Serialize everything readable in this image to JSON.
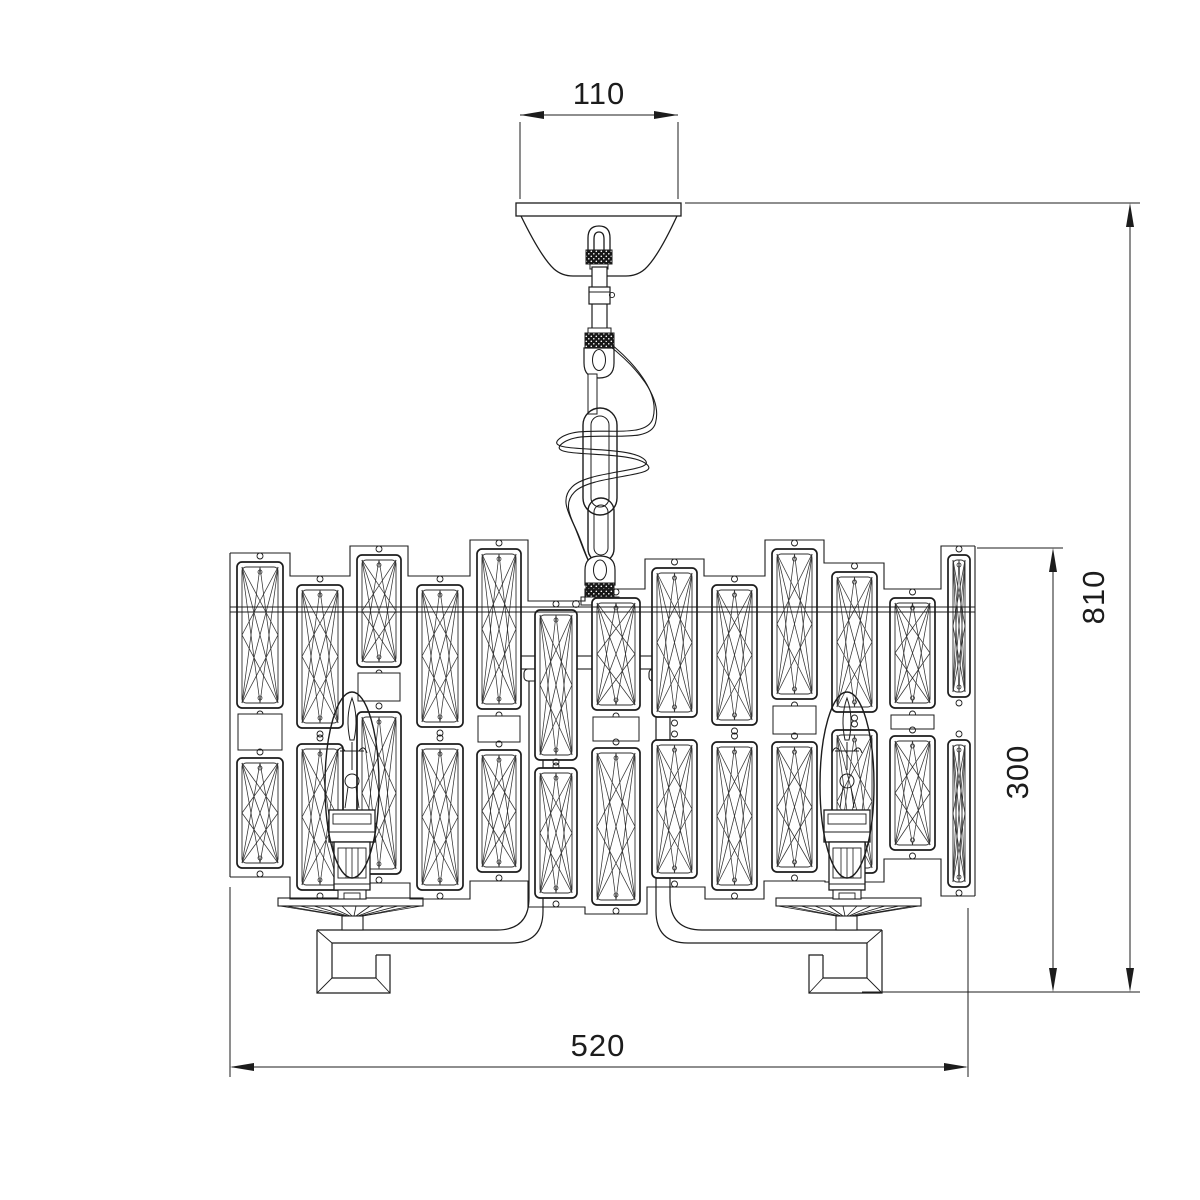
{
  "drawing": {
    "dimensions": {
      "canopy_width": "110",
      "overall_height": "810",
      "body_height": "300",
      "body_width": "520"
    },
    "colors": {
      "line": "#1c1c1c",
      "background": "#ffffff"
    }
  }
}
